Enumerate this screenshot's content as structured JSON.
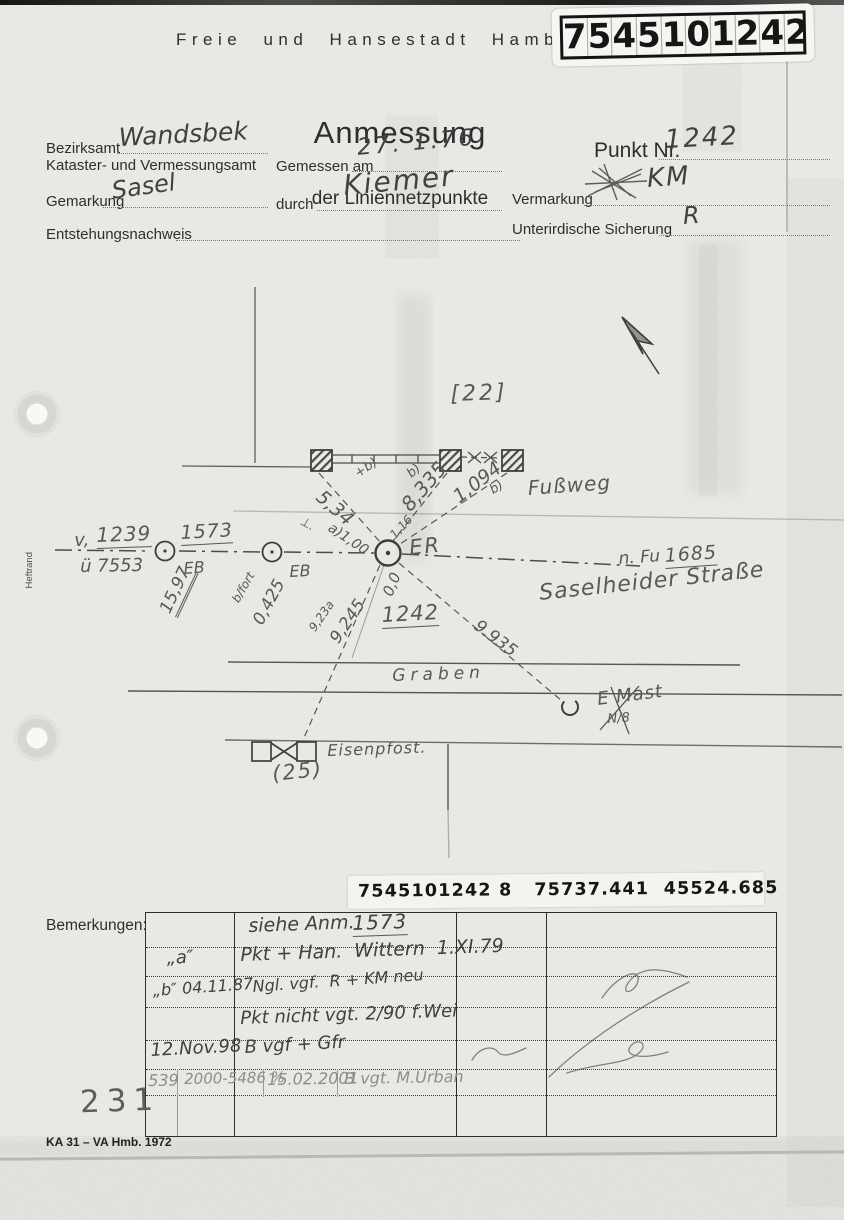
{
  "header": {
    "agency": "Freie und Hansestadt Hamb",
    "stamp_digits": [
      "7",
      "5",
      "4",
      "5",
      "1",
      "0",
      "1",
      "2",
      "4",
      "2"
    ],
    "title": "Anmessung",
    "subtitle": "der Liniennetzpunkte"
  },
  "form": {
    "bezirksamt_label": "Bezirksamt",
    "bezirksamt_value": "Wandsbek",
    "kataster_label": "Kataster- und Vermessungsamt",
    "gemessen_label": "Gemessen am",
    "gemessen_value": "27. 1.76",
    "gemarkung_label": "Gemarkung",
    "gemarkung_value": "Sasel",
    "durch_label": "durch",
    "durch_value": "Kiemer",
    "entstehung_label": "Entstehungsnachweis",
    "punkt_label": "Punkt Nr.",
    "punkt_value": "1242",
    "vermarkung_label": "Vermarkung",
    "vermarkung_value": "KM",
    "sicherung_label": "Unterirdische Sicherung",
    "sicherung_value": "R"
  },
  "margin": {
    "heftrand": "Heftrand"
  },
  "sketch": {
    "block_ref": "[22]",
    "footpath": "Fußweg",
    "m_534": "5,34",
    "m_534_note": "+b)",
    "m_100_mark": "⊥.",
    "m_100": "a)1,00",
    "m_8335": "8,335",
    "m_8335_note": "b)",
    "m_116": "1,16",
    "m_1094": "1,094",
    "m_1094_note": "b)",
    "pt_prev_prefix": "v,",
    "pt_prev": "1239",
    "pt_prev_alt": "ü 7553",
    "pt_1573": "1573",
    "eb1": "EB",
    "m_1597": "15,97",
    "eb2": "EB",
    "m_0425_note": "b/fort",
    "m_0425": "0,425",
    "er": "ER",
    "m_00": "0,0",
    "point_number": "1242",
    "m_923": "9,23a",
    "m_9245": "9,245",
    "m_9935": "9.935",
    "next_prefix": "n. Fu",
    "next": "1685",
    "street": "Saselheider Straße",
    "ditch": "Graben",
    "mast": "E Mast",
    "mast_note": "N/8",
    "iron_post": "Eisenpfost.",
    "iron_post_ref": "(25)"
  },
  "coord_stamp": {
    "text": "7545101242 8   75737.441  45524.685"
  },
  "remarks": {
    "label": "Bemerkungen:",
    "row1": {
      "note_prefix": "siehe Anm.",
      "note_ref": "1573"
    },
    "row2": {
      "index": "„a″",
      "note": "Pkt + Han.  Wittern  1.XI.79"
    },
    "row3": {
      "index": "„b″ 04.11.87",
      "note": "Ngl. vgf.  R + KM neu"
    },
    "row4": {
      "note": "Pkt nicht vgt. 2/90 f.Wei"
    },
    "row5": {
      "index": "12.Nov.98",
      "note": "B vgf + Gfr"
    },
    "row6": {
      "c1": "539",
      "c2": "2000-5486 %",
      "c3": "15.02.2001",
      "c4": "B vgt. M.Urban"
    }
  },
  "footer": {
    "page_stamp": "231",
    "form_code": "KA 31 – VA Hmb. 1972"
  }
}
